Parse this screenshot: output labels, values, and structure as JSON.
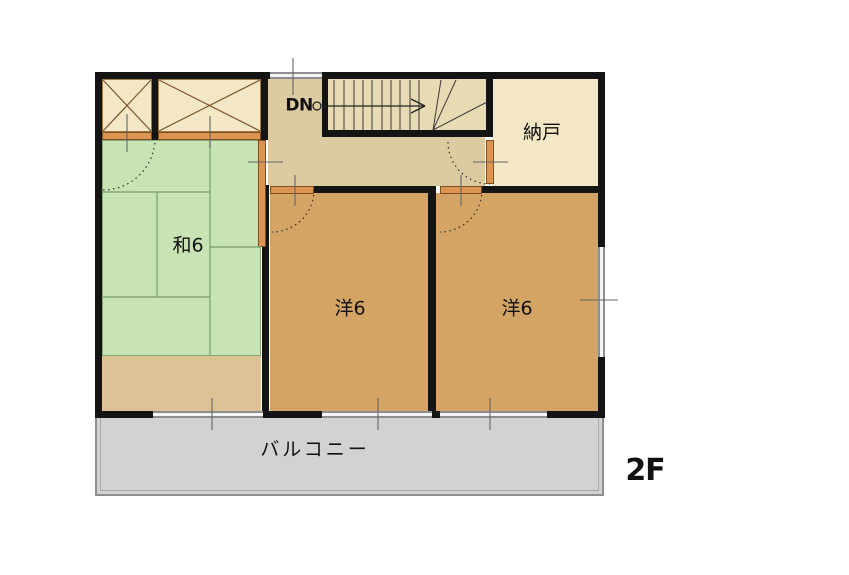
{
  "plan": {
    "floor_label": "2F",
    "stairs": {
      "dn_label": "DN"
    },
    "rooms": {
      "japanese_room": {
        "label": "和6"
      },
      "western_room_1": {
        "label": "洋6"
      },
      "western_room_2": {
        "label": "洋6"
      },
      "storage_room": {
        "label": "納戸"
      },
      "balcony": {
        "label": "バルコニー"
      }
    },
    "colors": {
      "wall": "#141414",
      "tatami_green": "#c8e4b4",
      "western_room_brown": "#d3a463",
      "hall_tan": "#dccaa0",
      "stairwell_cream": "#e8dab2",
      "storage_cream": "#f3e7c6",
      "engawa_tan": "#dcc294",
      "balcony_gray": "#d2d2d2",
      "door_orange": "#dc9452"
    }
  }
}
